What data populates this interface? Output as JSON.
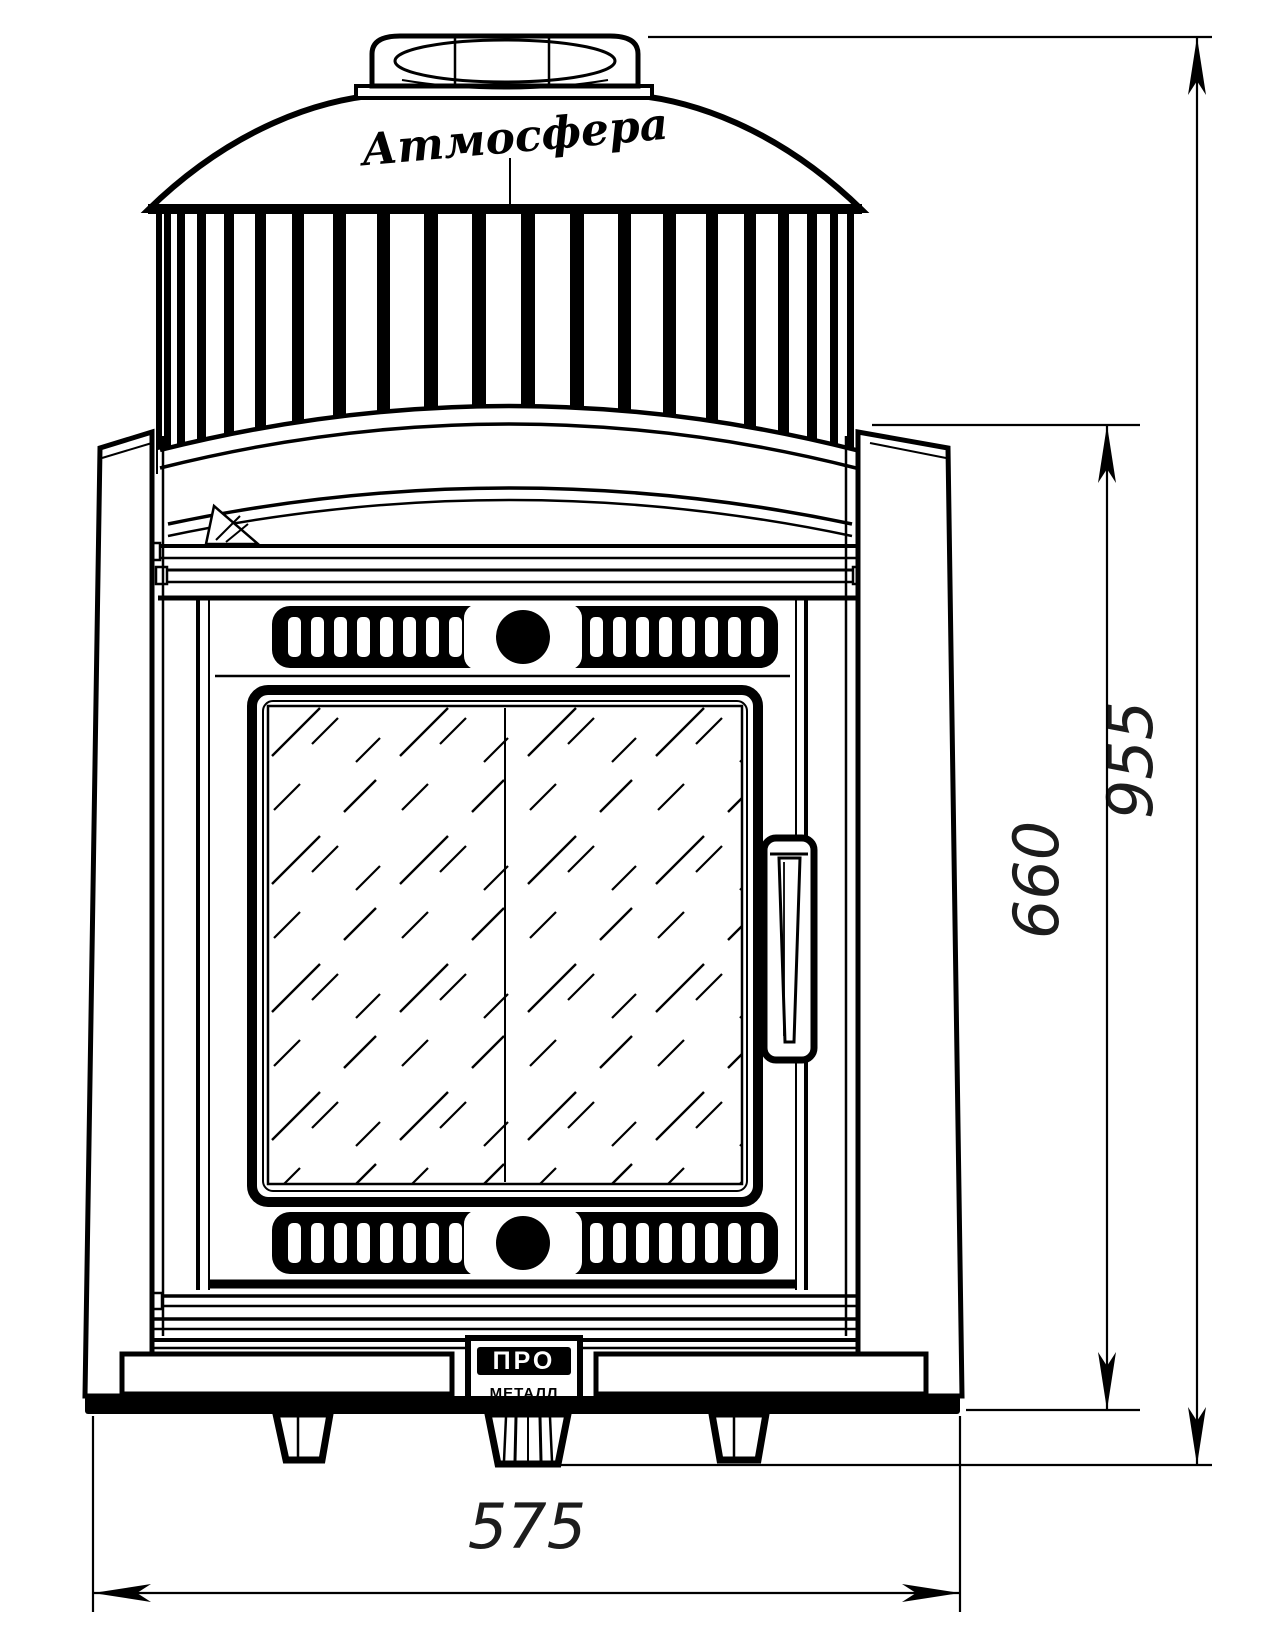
{
  "stove": {
    "brand_script": "Атмосфера",
    "logo_top": "ПРО",
    "logo_bottom": "МЕТАЛЛ"
  },
  "dimensions": {
    "overall_height_mm": "955",
    "body_height_mm": "660",
    "width_mm": "575"
  },
  "colors": {
    "line": "#000000",
    "background": "#ffffff",
    "dim_text": "#1c1c1c"
  }
}
